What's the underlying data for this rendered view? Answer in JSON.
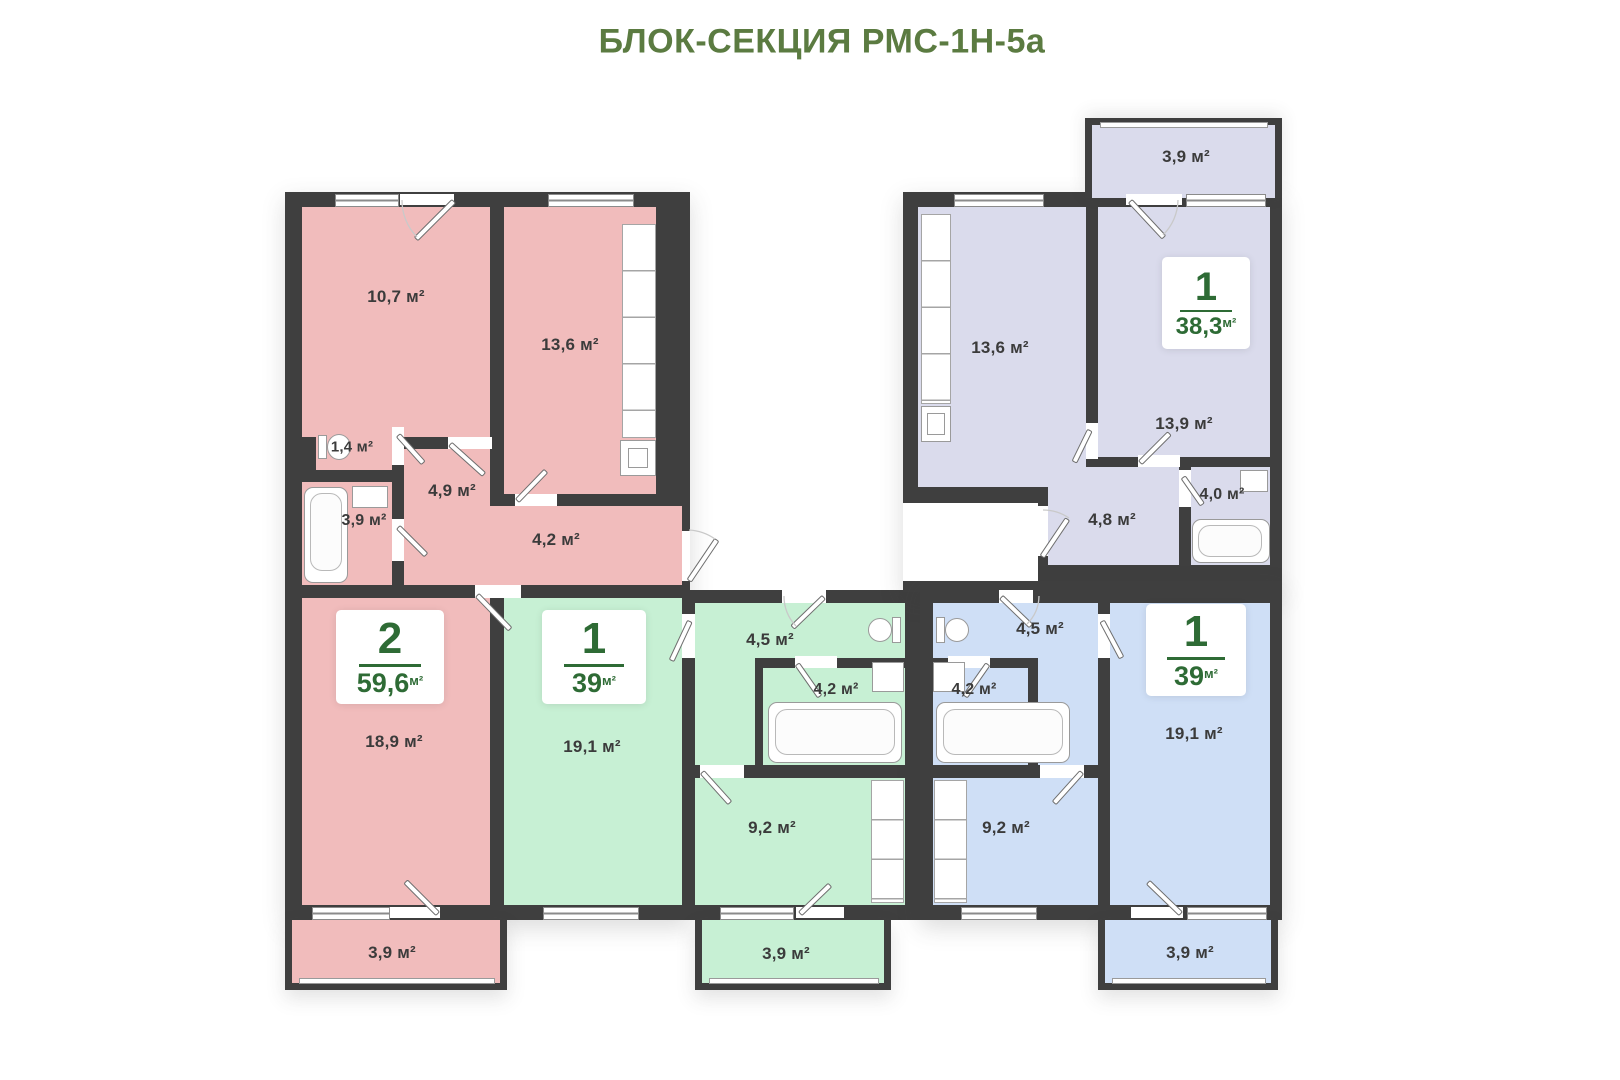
{
  "title": "БЛОК-СЕКЦИЯ РМС-1Н-5а",
  "colors": {
    "wall": "#3f3f3f",
    "pink": "#f1bcbc",
    "green": "#c7f0d4",
    "blue": "#cfdff6",
    "lavender": "#dadbec",
    "badge_green": "#2e6b35",
    "title_green": "#5b7b41",
    "label_text": "#3b3b3b"
  },
  "units": [
    {
      "name": "apartment-2rooms-59.6",
      "badge": {
        "rooms": "2",
        "area": "59,6",
        "unit": "м²"
      },
      "rooms": {
        "room1": "10,7 м²",
        "kitchen": "13,6 м²",
        "wc": "1,4 м²",
        "bath": "3,9 м²",
        "hall": "4,9 м²",
        "corridor": "4,2 м²",
        "living": "18,9 м²",
        "balcony": "3,9 м²"
      }
    },
    {
      "name": "apartment-1room-39-green",
      "badge": {
        "rooms": "1",
        "area": "39",
        "unit": "м²"
      },
      "rooms": {
        "living": "19,1 м²",
        "hall": "4,5 м²",
        "bath": "4,2 м²",
        "kitchen": "9,2 м²",
        "balcony": "3,9 м²"
      }
    },
    {
      "name": "apartment-1room-39-blue",
      "badge": {
        "rooms": "1",
        "area": "39",
        "unit": "м²"
      },
      "rooms": {
        "hall": "4,5 м²",
        "bath": "4,2 м²",
        "kitchen": "9,2 м²",
        "living": "19,1 м²",
        "balcony": "3,9 м²"
      }
    },
    {
      "name": "apartment-1room-38.3",
      "badge": {
        "rooms": "1",
        "area": "38,3",
        "unit": "м²"
      },
      "rooms": {
        "balcony": "3,9 м²",
        "kitchen": "13,6 м²",
        "living": "13,9 м²",
        "bath": "4,0 м²",
        "hall": "4,8 м²"
      }
    }
  ]
}
